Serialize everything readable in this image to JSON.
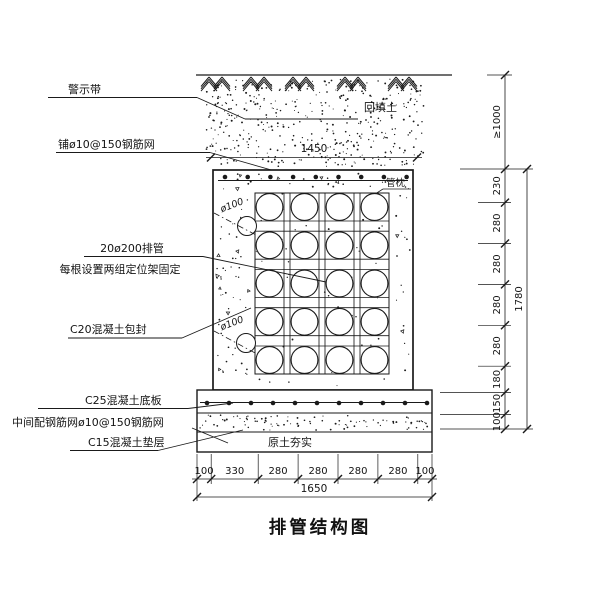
{
  "title": "排管结构图",
  "labels": {
    "warning_tape": "警示带",
    "top_mesh": "铺ø10@150钢筋网",
    "backfill_soil": "回填土",
    "pipe_pillow": "管枕",
    "pipe_bank_line1": "20ø200排管",
    "pipe_bank_line2": "每根设置两组定位架固定",
    "concrete_encase": "C20混凝土包封",
    "base_slab": "C25混凝土底板",
    "slab_mid_mesh": "中间配钢筋网ø10@150钢筋网",
    "cushion": "C15混凝土垫层",
    "compacted_soil": "原土夯实",
    "conduit_dia_top": "ø100",
    "conduit_dia_bottom": "ø100"
  },
  "dimensions": {
    "trench_width_top": "1450",
    "base_width_total": "1650",
    "base_segments": [
      "100",
      "330",
      "280",
      "280",
      "280",
      "280",
      "100"
    ],
    "height_total": "1780",
    "cover_depth": "≥1000",
    "height_segments": [
      "230",
      "280",
      "280",
      "280",
      "280",
      "180",
      "150",
      "100"
    ]
  },
  "pipe_grid": {
    "columns": 4,
    "rows": 5,
    "pipe_count": 20
  },
  "colors": {
    "ink": "#1a1a1a",
    "paper": "#ffffff"
  }
}
